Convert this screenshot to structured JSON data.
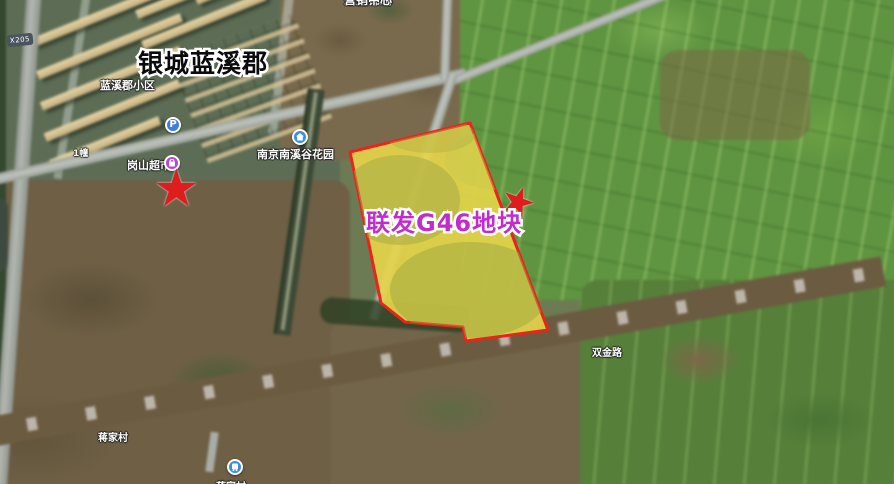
{
  "map_annotations": {
    "road_badge": "X205",
    "community_title": "银城蓝溪郡",
    "community_sub": "蓝溪郡小区",
    "building_label": "1幢",
    "supermarket_label": "岗山超市",
    "garden_label": "南京南溪谷花园",
    "marketing_center_line1": "荣盛锦绣",
    "marketing_center_line2": "营销中心",
    "plot_label": "联发G46地块",
    "road_label_east": "双金路",
    "village_label": "蒋家村",
    "parking_glyph": "P",
    "star_glyph": "★"
  },
  "colors": {
    "plot_fill_yellow": "#ffe400",
    "plot_border_red": "#e8241c",
    "plot_label_magenta": "#bf2ecc",
    "star_red": "#df1c1e",
    "parking_blue": "#3b7de0",
    "poi_blue": "#3b8fd8",
    "supermarket_purple": "#b44ad0",
    "road_badge_bg": "#49545e"
  }
}
